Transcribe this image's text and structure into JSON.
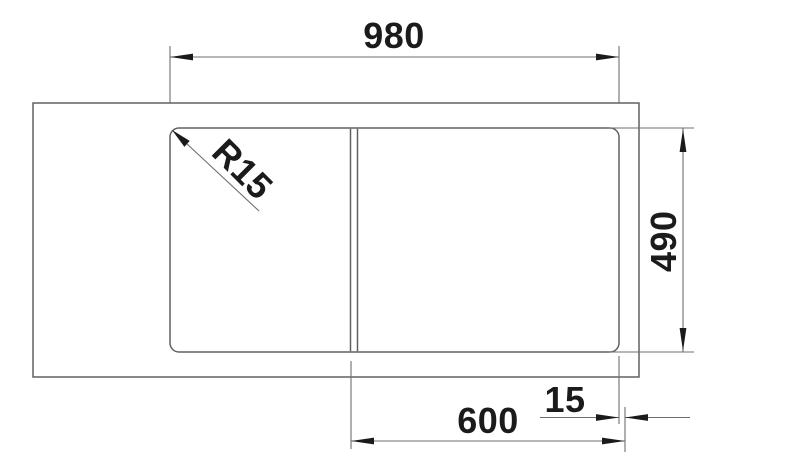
{
  "drawing": {
    "labels": {
      "overall_width": "980",
      "corner_radius": "R15",
      "overall_depth": "490",
      "bowl_width": "600",
      "edge_offset": "15"
    },
    "colors": {
      "line": "#6e6f71",
      "outline": "#606164",
      "text": "#1b1b1b",
      "arrow": "#1b1b1b",
      "background": "#ffffff"
    }
  }
}
